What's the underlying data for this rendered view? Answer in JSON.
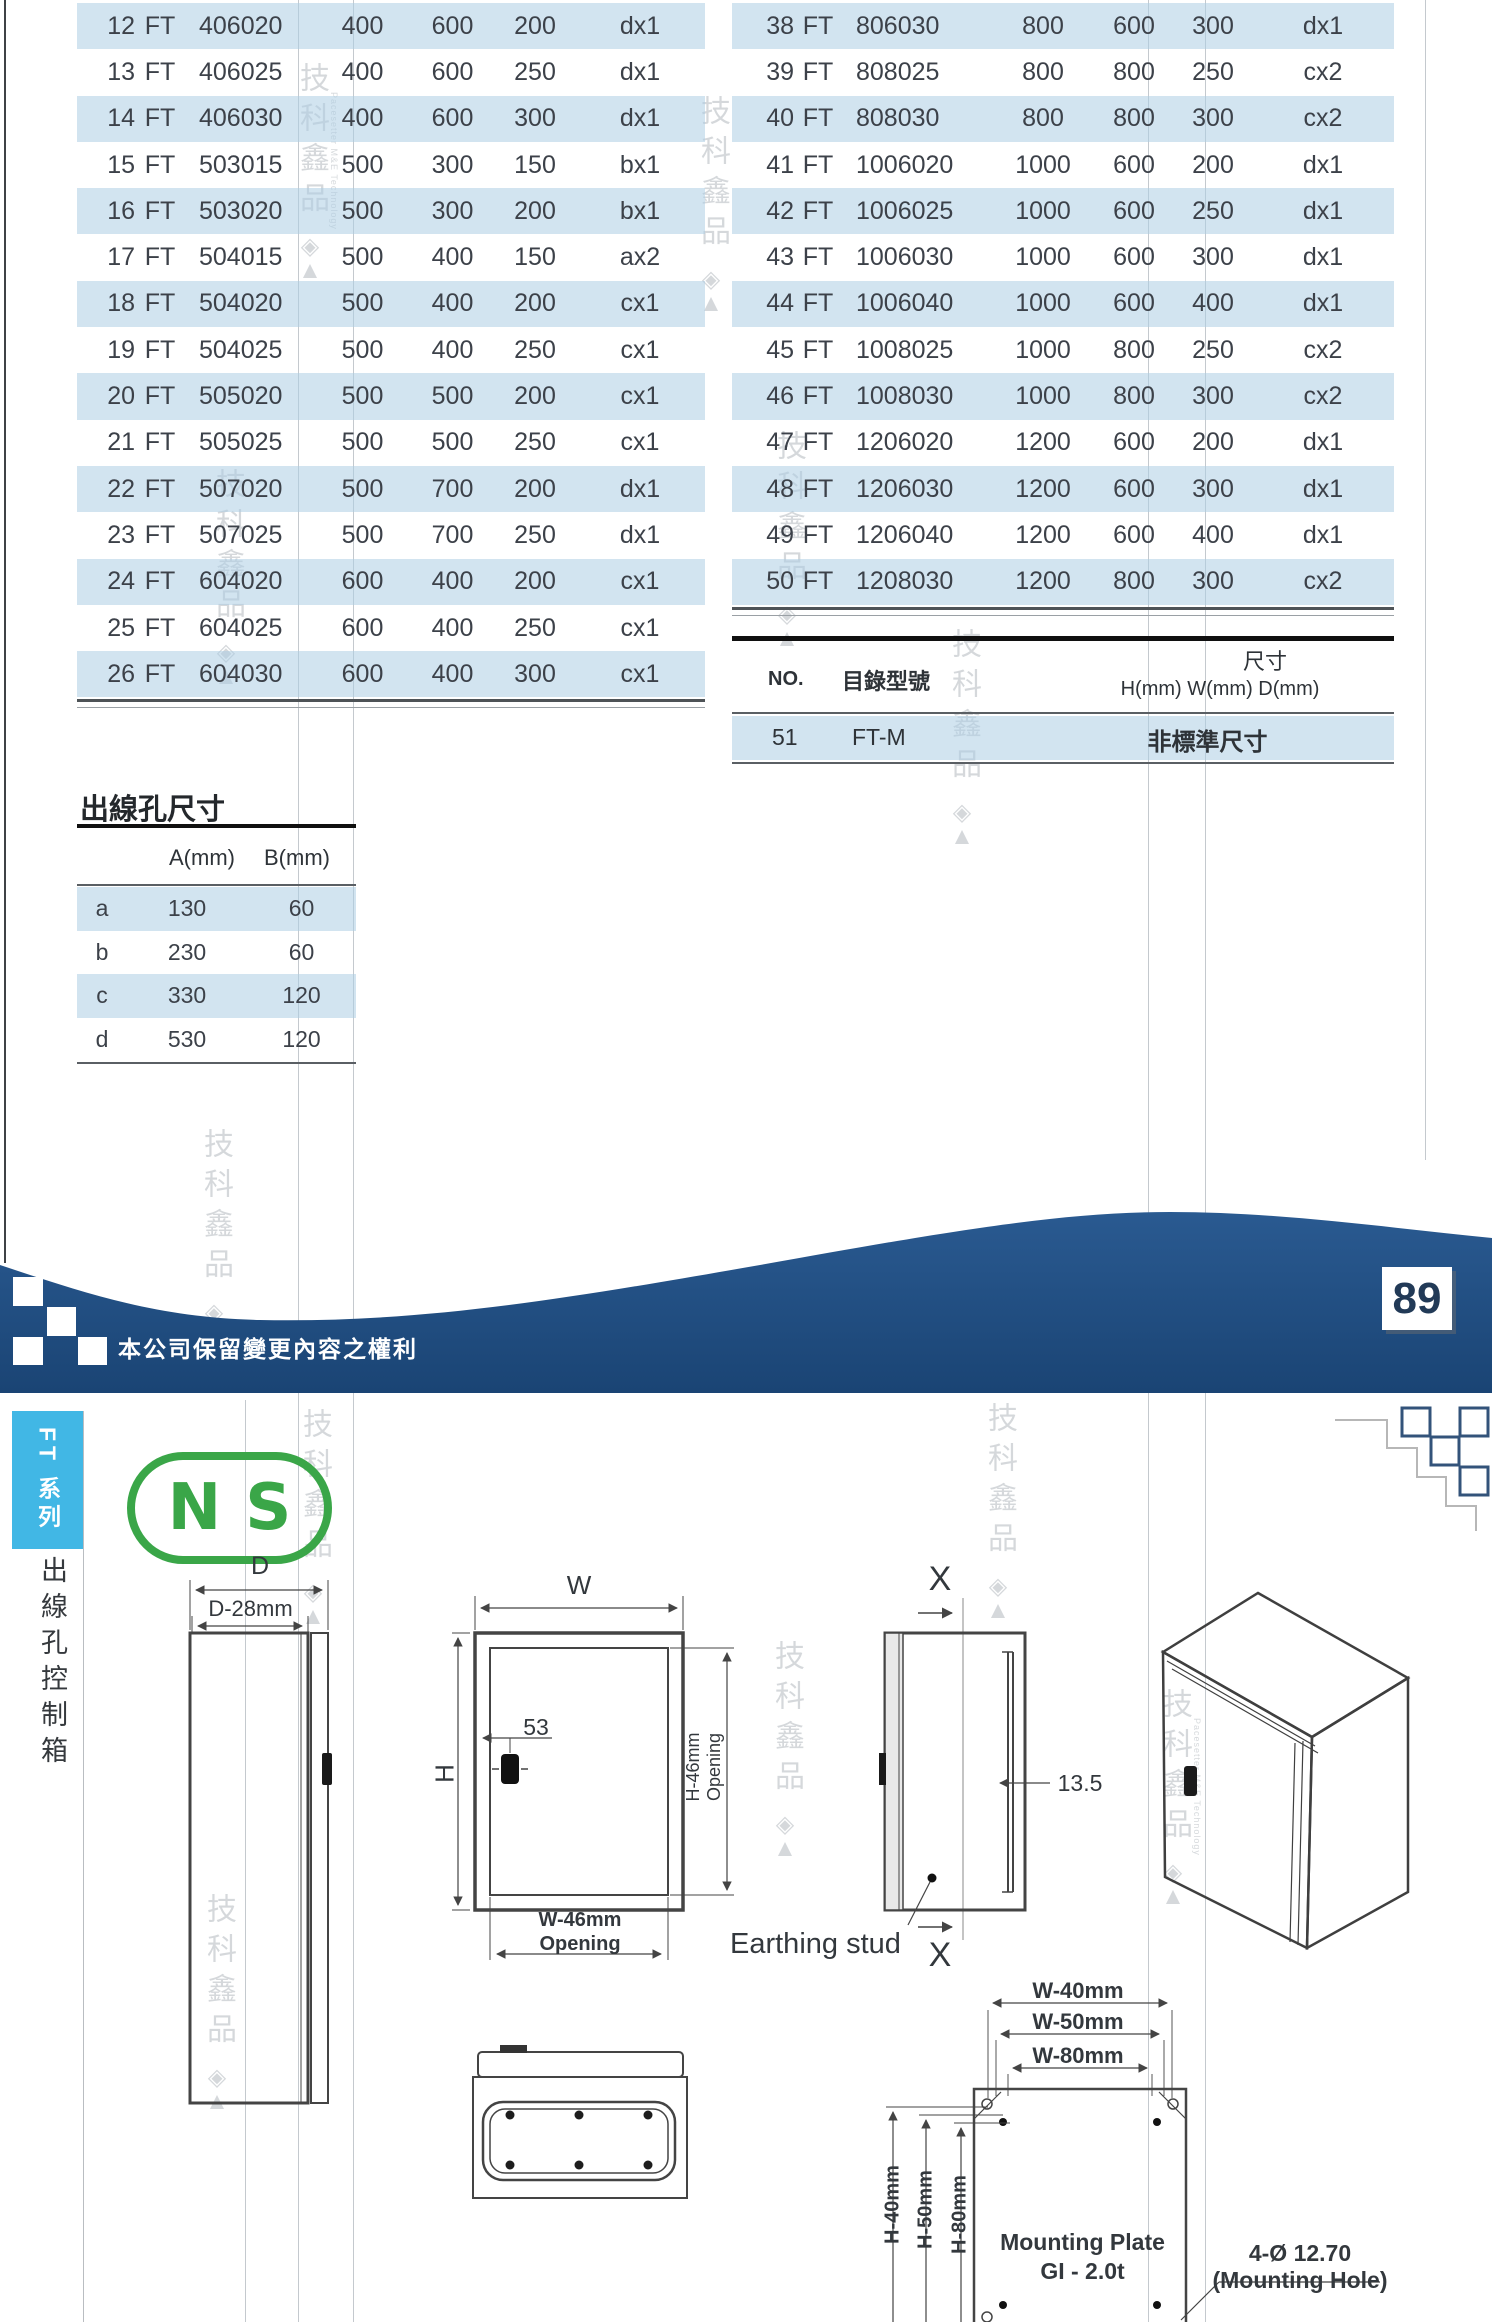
{
  "page": {
    "number": "89",
    "rights_note": "本公司保留變更內容之權利"
  },
  "catalog_tables": {
    "left_rows": [
      {
        "no": "12",
        "brand": "FT",
        "model": "406020",
        "h": "400",
        "w": "600",
        "d": "200",
        "type": "dx1"
      },
      {
        "no": "13",
        "brand": "FT",
        "model": "406025",
        "h": "400",
        "w": "600",
        "d": "250",
        "type": "dx1"
      },
      {
        "no": "14",
        "brand": "FT",
        "model": "406030",
        "h": "400",
        "w": "600",
        "d": "300",
        "type": "dx1"
      },
      {
        "no": "15",
        "brand": "FT",
        "model": "503015",
        "h": "500",
        "w": "300",
        "d": "150",
        "type": "bx1"
      },
      {
        "no": "16",
        "brand": "FT",
        "model": "503020",
        "h": "500",
        "w": "300",
        "d": "200",
        "type": "bx1"
      },
      {
        "no": "17",
        "brand": "FT",
        "model": "504015",
        "h": "500",
        "w": "400",
        "d": "150",
        "type": "ax2"
      },
      {
        "no": "18",
        "brand": "FT",
        "model": "504020",
        "h": "500",
        "w": "400",
        "d": "200",
        "type": "cx1"
      },
      {
        "no": "19",
        "brand": "FT",
        "model": "504025",
        "h": "500",
        "w": "400",
        "d": "250",
        "type": "cx1"
      },
      {
        "no": "20",
        "brand": "FT",
        "model": "505020",
        "h": "500",
        "w": "500",
        "d": "200",
        "type": "cx1"
      },
      {
        "no": "21",
        "brand": "FT",
        "model": "505025",
        "h": "500",
        "w": "500",
        "d": "250",
        "type": "cx1"
      },
      {
        "no": "22",
        "brand": "FT",
        "model": "507020",
        "h": "500",
        "w": "700",
        "d": "200",
        "type": "dx1"
      },
      {
        "no": "23",
        "brand": "FT",
        "model": "507025",
        "h": "500",
        "w": "700",
        "d": "250",
        "type": "dx1"
      },
      {
        "no": "24",
        "brand": "FT",
        "model": "604020",
        "h": "600",
        "w": "400",
        "d": "200",
        "type": "cx1"
      },
      {
        "no": "25",
        "brand": "FT",
        "model": "604025",
        "h": "600",
        "w": "400",
        "d": "250",
        "type": "cx1"
      },
      {
        "no": "26",
        "brand": "FT",
        "model": "604030",
        "h": "600",
        "w": "400",
        "d": "300",
        "type": "cx1"
      }
    ],
    "right_rows": [
      {
        "no": "38",
        "brand": "FT",
        "model": "806030",
        "h": "800",
        "w": "600",
        "d": "300",
        "type": "dx1"
      },
      {
        "no": "39",
        "brand": "FT",
        "model": "808025",
        "h": "800",
        "w": "800",
        "d": "250",
        "type": "cx2"
      },
      {
        "no": "40",
        "brand": "FT",
        "model": "808030",
        "h": "800",
        "w": "800",
        "d": "300",
        "type": "cx2"
      },
      {
        "no": "41",
        "brand": "FT",
        "model": "1006020",
        "h": "1000",
        "w": "600",
        "d": "200",
        "type": "dx1"
      },
      {
        "no": "42",
        "brand": "FT",
        "model": "1006025",
        "h": "1000",
        "w": "600",
        "d": "250",
        "type": "dx1"
      },
      {
        "no": "43",
        "brand": "FT",
        "model": "1006030",
        "h": "1000",
        "w": "600",
        "d": "300",
        "type": "dx1"
      },
      {
        "no": "44",
        "brand": "FT",
        "model": "1006040",
        "h": "1000",
        "w": "600",
        "d": "400",
        "type": "dx1"
      },
      {
        "no": "45",
        "brand": "FT",
        "model": "1008025",
        "h": "1000",
        "w": "800",
        "d": "250",
        "type": "cx2"
      },
      {
        "no": "46",
        "brand": "FT",
        "model": "1008030",
        "h": "1000",
        "w": "800",
        "d": "300",
        "type": "cx2"
      },
      {
        "no": "47",
        "brand": "FT",
        "model": "1206020",
        "h": "1200",
        "w": "600",
        "d": "200",
        "type": "dx1"
      },
      {
        "no": "48",
        "brand": "FT",
        "model": "1206030",
        "h": "1200",
        "w": "600",
        "d": "300",
        "type": "dx1"
      },
      {
        "no": "49",
        "brand": "FT",
        "model": "1206040",
        "h": "1200",
        "w": "600",
        "d": "400",
        "type": "dx1"
      },
      {
        "no": "50",
        "brand": "FT",
        "model": "1208030",
        "h": "1200",
        "w": "800",
        "d": "300",
        "type": "cx2"
      }
    ],
    "custom_size_table": {
      "no_header": "NO.",
      "model_header": "目錄型號",
      "size_header": "尺寸",
      "size_subheader": "H(mm) W(mm) D(mm)",
      "row_no": "51",
      "row_model": "FT-M",
      "row_size": "非標準尺寸"
    }
  },
  "opening_table": {
    "title": "出線孔尺寸",
    "col_a": "A(mm)",
    "col_b": "B(mm)",
    "rows": [
      {
        "key": "a",
        "a": "130",
        "b": "60"
      },
      {
        "key": "b",
        "a": "230",
        "b": "60"
      },
      {
        "key": "c",
        "a": "330",
        "b": "120"
      },
      {
        "key": "d",
        "a": "530",
        "b": "120"
      }
    ]
  },
  "series": {
    "tab": "FT 系列",
    "vertical_title": "出線孔控制箱",
    "logo": "NS"
  },
  "drawings": {
    "side_view": {
      "dim_d": "D",
      "dim_d28": "D-28mm"
    },
    "front_view": {
      "dim_w": "W",
      "dim_h": "H",
      "dim_53": "53",
      "h_opening_line1": "H-46mm",
      "h_opening_line2": "Opening",
      "w_opening_line1": "W-46mm",
      "w_opening_line2": "Opening"
    },
    "section_view": {
      "x_top": "X",
      "x_bottom": "X",
      "dim_135": "13.5",
      "earthing_label": "Earthing stud"
    },
    "mounting_plate": {
      "w40": "W-40mm",
      "w50": "W-50mm",
      "w80": "W-80mm",
      "h40": "H-40mm",
      "h50": "H-50mm",
      "h80": "H-80mm",
      "title_line1": "Mounting Plate",
      "title_line2": "GI - 2.0t",
      "hole_line1": "4-Ø 12.70",
      "hole_line2": "(Mounting Hole)"
    }
  },
  "watermark": {
    "brand": "品鑫科技",
    "vertical_text_top_to_bottom": "技科鑫品",
    "english": "Pacesetter M&E Technology",
    "logo_glyphs": "◈ ▲"
  },
  "colors": {
    "row_blue": "#d2e4f0",
    "wave_navy": "#1f4c80",
    "tab_cyan": "#41b7e5",
    "logo_green": "#3aa648"
  }
}
